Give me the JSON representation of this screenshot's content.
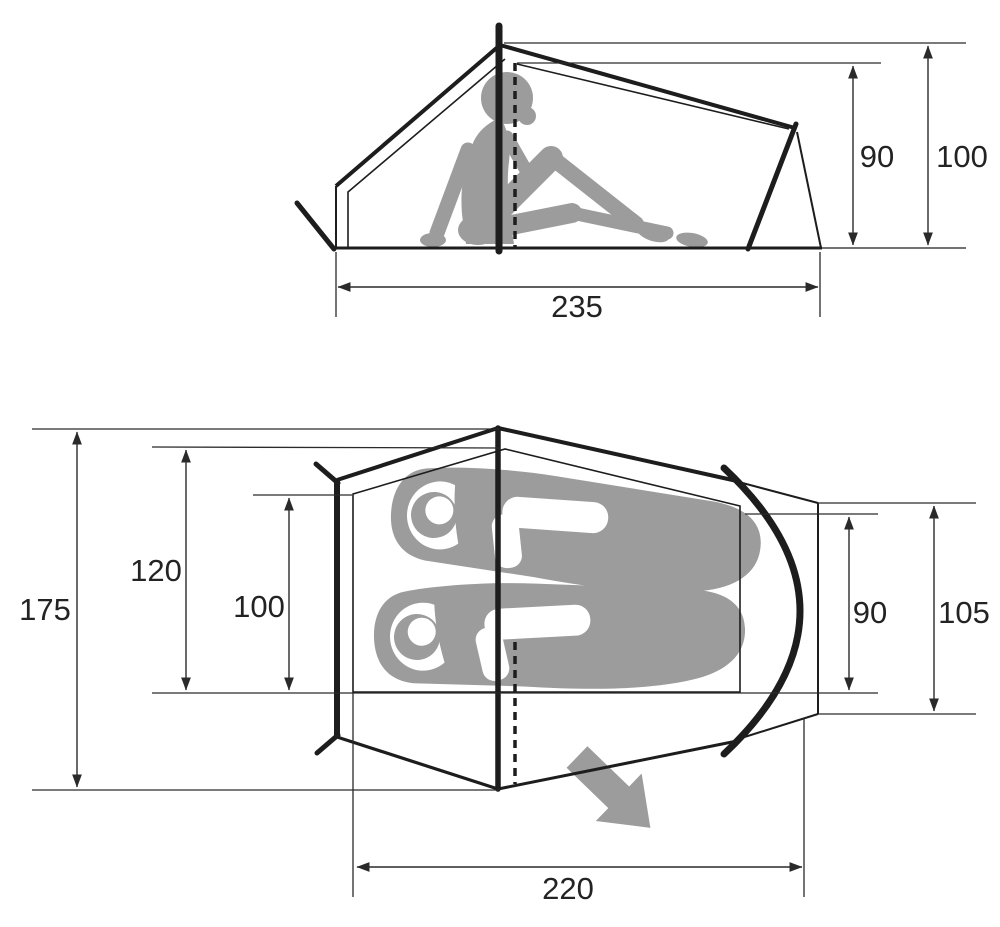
{
  "diagram": {
    "subject": "tent-dimension-diagram",
    "side_view": {
      "dims": {
        "inner_height": "90",
        "peak_height": "100",
        "floor_length": "235"
      }
    },
    "plan_view": {
      "dims": {
        "overall_width": "175",
        "inner_width_max": "120",
        "inner_width_head_end": "100",
        "inner_width_foot_end": "90",
        "outer_width_foot_end": "105",
        "inner_length": "220"
      }
    },
    "colors": {
      "line": "#1d1d1d",
      "silhouette": "#9c9c9c",
      "background": "#ffffff",
      "text": "#232323"
    }
  }
}
